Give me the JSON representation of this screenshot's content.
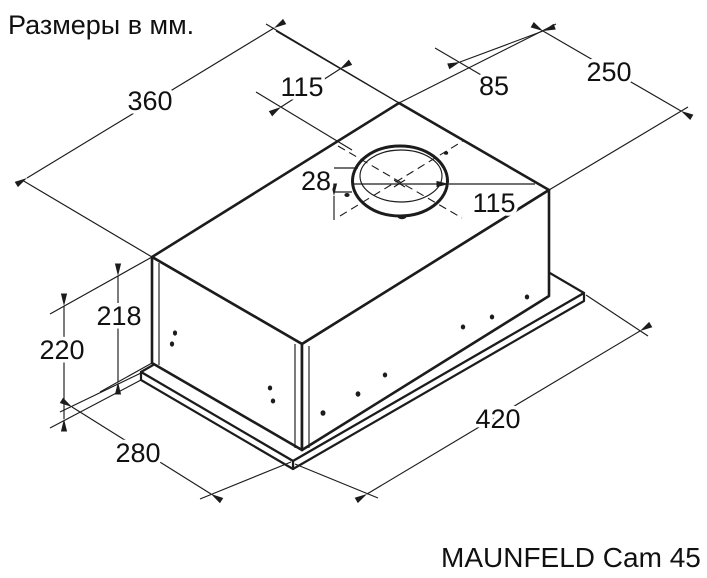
{
  "title": "Размеры в мм.",
  "caption": "MAUNFELD Cam 45",
  "drawing": {
    "type": "isometric technical drawing",
    "subject": "built-in cooker hood with top duct collar and mounting base plate",
    "units": "мм"
  },
  "dimensions": {
    "top_width": "360",
    "collar_width_offset": "115",
    "collar_side_offset": "85",
    "top_depth": "250",
    "collar_height": "28",
    "collar_diameter": "115",
    "body_height": "218",
    "total_height": "220",
    "base_depth": "280",
    "base_width": "420"
  },
  "colors": {
    "line": "#1c1c1c",
    "background": "#ffffff"
  }
}
